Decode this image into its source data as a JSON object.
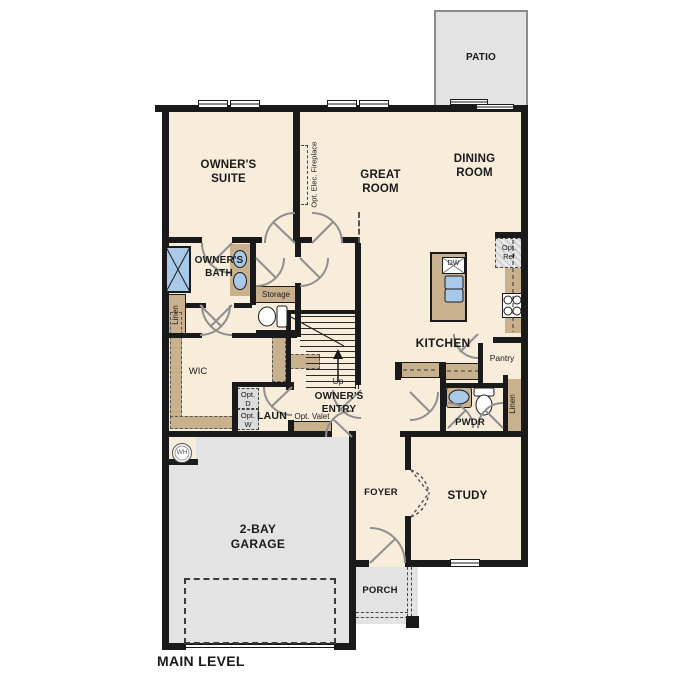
{
  "title": "MAIN LEVEL",
  "colors": {
    "floor": "#f8ecdb",
    "wall": "#1a1a1a",
    "outdoor_gray": "#e3e3e3",
    "cabinet_tan": "#c9b18e",
    "fixture_blue": "#a9c9e9",
    "door_arc_gray": "#8f8f8f"
  },
  "rooms": {
    "patio": "PATIO",
    "owners_suite": "OWNER'S SUITE",
    "great_room": "GREAT ROOM",
    "dining_room": "DINING ROOM",
    "owners_bath": "OWNER'S BATH",
    "linen_left": "Linen",
    "linen_right": "Linen",
    "storage": "Storage",
    "wic": "WIC",
    "kitchen": "KITCHEN",
    "pantry": "Pantry",
    "owners_entry": "OWNER'S ENTRY",
    "laundry": "LAUN",
    "powder": "PWDR",
    "foyer": "FOYER",
    "study": "STUDY",
    "garage": "2-BAY GARAGE",
    "porch": "PORCH"
  },
  "options": {
    "fireplace": "Opt. Elec. Fireplace",
    "refrigerator": "Opt. Ref",
    "dryer": "Opt. D",
    "washer": "Opt. W",
    "valet": "Opt. Valet"
  },
  "fixtures": {
    "dishwasher": "DW",
    "water_heater": "WH",
    "stairs_direction": "Up"
  }
}
